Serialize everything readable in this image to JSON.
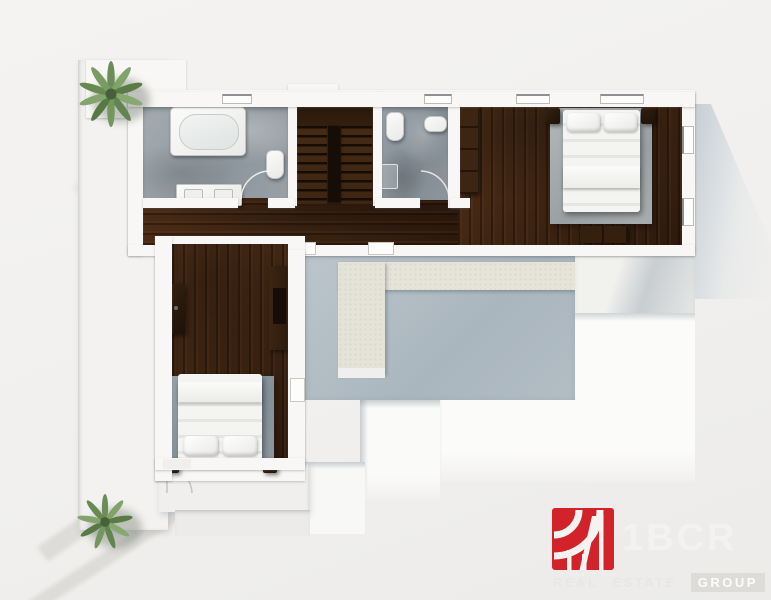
{
  "logo": {
    "brand": "1BCR",
    "tagline_words": [
      "REAL",
      "ESTATE",
      "GROUP"
    ],
    "mark_color": "#d2232b",
    "brand_text_color": "#f4f2f1"
  },
  "palette": {
    "background": "#f1f0ee",
    "wall": "#f8f7f5",
    "wood_floor": "#46291a",
    "stairs_wood": "#321e10",
    "marble_floor": "#99a1a8",
    "terrace_floor": "#b4bfc6",
    "terrace_path": "#e6e3d8",
    "rug": "#97a0a5",
    "bed_linen": "#f3f3f1",
    "plant_green": "#7c9a68",
    "ground_shadow": "#ccd4da"
  }
}
